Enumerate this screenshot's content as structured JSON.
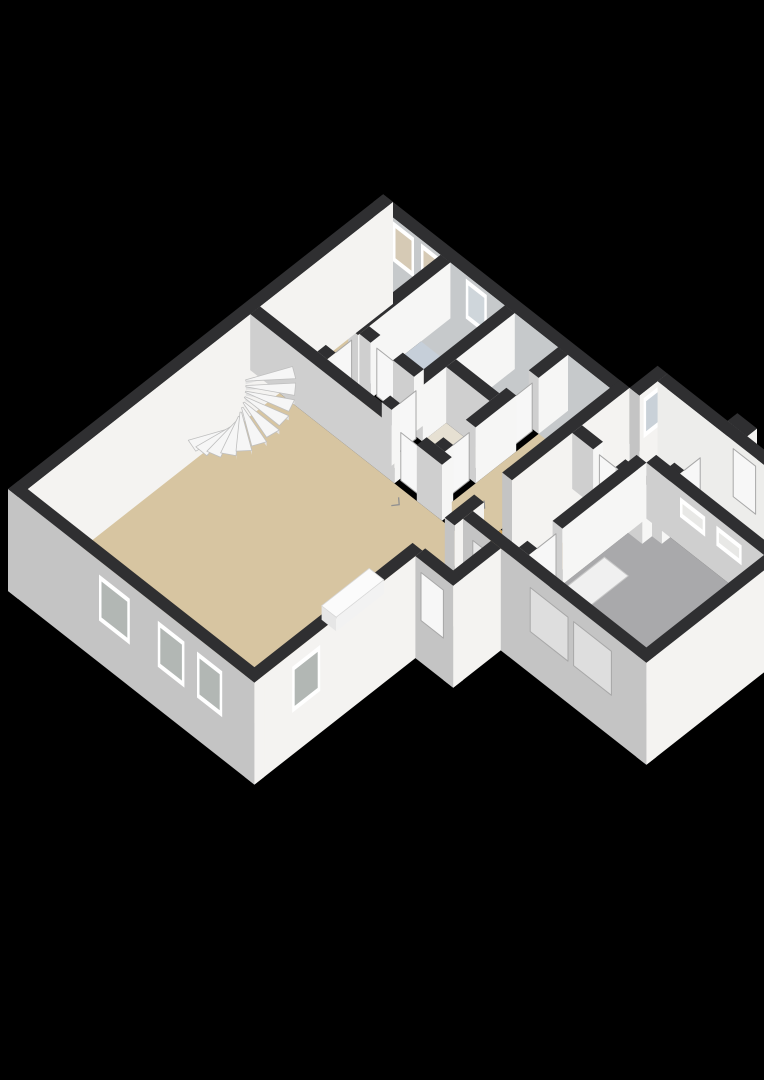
{
  "scene": {
    "kind": "isometric-3d-floorplan-render",
    "background": "#000000",
    "width": 764,
    "height": 1080
  },
  "palette": {
    "background": "#000000",
    "wallTop": "#2f2f31",
    "extSW": "#c4c4c4",
    "extSE": "#f4f3f1",
    "intSW": "#cfcfcf",
    "intSE": "#f6f6f5",
    "frame": "#ffffff",
    "leaf": "#f7f7f7",
    "leafStroke": "#a8a8a8",
    "floorTan": "#d7c5a1",
    "floorOrange": "#d2a75e",
    "floorBlue": "#c4ccd6",
    "floorGray": "#a9a9ab",
    "floorMutedTan": "#c6b795"
  },
  "plan": {
    "projection": {
      "ox": 8,
      "oy": 545,
      "k": 28,
      "m": 22,
      "wallHeight": 56,
      "plinth": 46
    },
    "floors": [
      {
        "name": "living-room-floor",
        "points": [
          [
            0.35,
            0.35
          ],
          [
            8.3,
            0.35
          ],
          [
            8.3,
            8.45
          ],
          [
            0.35,
            8.45
          ]
        ],
        "color": "#d7c5a1"
      },
      {
        "name": "bedroom-floor",
        "points": [
          [
            8.65,
            0.35
          ],
          [
            13.05,
            0.35
          ],
          [
            13.05,
            2.4
          ],
          [
            8.65,
            2.4
          ]
        ],
        "color": "#d7c5a1"
      },
      {
        "name": "inner-hall-floor",
        "points": [
          [
            8.65,
            2.75
          ],
          [
            9.8,
            2.75
          ],
          [
            9.8,
            4.7
          ],
          [
            8.65,
            4.7
          ]
        ],
        "color": "#dcd0b4"
      },
      {
        "name": "bathroom-floor",
        "points": [
          [
            10.15,
            2.75
          ],
          [
            13.05,
            2.75
          ],
          [
            13.05,
            4.7
          ],
          [
            10.15,
            4.7
          ]
        ],
        "color": "#c6cfd9"
      },
      {
        "name": "closet-a-floor",
        "points": [
          [
            8.65,
            5.05
          ],
          [
            10.6,
            5.05
          ],
          [
            10.6,
            6.6
          ],
          [
            8.65,
            6.6
          ]
        ],
        "color": "#e6e0d2"
      },
      {
        "name": "closet-b-floor",
        "points": [
          [
            10.95,
            5.05
          ],
          [
            13.05,
            5.05
          ],
          [
            13.05,
            6.6
          ],
          [
            10.95,
            6.6
          ]
        ],
        "color": "#e6e0d2"
      },
      {
        "name": "entry-hall-floor",
        "points": [
          [
            8.65,
            6.95
          ],
          [
            13.05,
            6.95
          ],
          [
            13.05,
            8.45
          ],
          [
            8.65,
            8.45
          ]
        ],
        "color": "#d8c7a4"
      },
      {
        "name": "vestibule-floor",
        "points": [
          [
            6.05,
            8.45
          ],
          [
            7.12,
            8.45
          ],
          [
            7.12,
            9.8
          ],
          [
            6.05,
            9.8
          ]
        ],
        "color": "#d5c29c"
      },
      {
        "name": "west-hall-floor",
        "points": [
          [
            7.8,
            8.8
          ],
          [
            11.35,
            8.8
          ],
          [
            11.35,
            10.45
          ],
          [
            7.8,
            10.45
          ]
        ],
        "color": "#d2a75e"
      },
      {
        "name": "hall-doorway-floor",
        "points": [
          [
            8.25,
            8.45
          ],
          [
            9.15,
            8.45
          ],
          [
            9.15,
            8.8
          ],
          [
            8.25,
            8.8
          ]
        ],
        "color": "#d2a75e"
      },
      {
        "name": "corridor-floor",
        "points": [
          [
            11.7,
            8.8
          ],
          [
            13.4,
            8.8
          ],
          [
            13.4,
            9.15
          ],
          [
            14.05,
            9.15
          ],
          [
            14.05,
            11.3
          ],
          [
            11.7,
            11.3
          ]
        ],
        "color": "#c4ccd6"
      },
      {
        "name": "garage-floor",
        "points": [
          [
            7.8,
            10.8
          ],
          [
            12.0,
            10.8
          ],
          [
            12.0,
            15.0
          ],
          [
            7.8,
            15.0
          ]
        ],
        "color": "#a9a9ab"
      },
      {
        "name": "storeroom-floor",
        "points": [
          [
            12.35,
            11.65
          ],
          [
            14.05,
            11.65
          ],
          [
            14.05,
            15.0
          ],
          [
            12.35,
            15.0
          ]
        ],
        "color": "#c6b795"
      }
    ],
    "flat_details": [
      {
        "name": "garage-floor-hatch",
        "points": [
          [
            8.35,
            10.95
          ],
          [
            10.35,
            10.95
          ],
          [
            10.35,
            11.8
          ],
          [
            8.35,
            11.8
          ]
        ],
        "color": "#f0f0f0",
        "stroke": "#c8c8c8"
      }
    ],
    "door_marks": [
      {
        "name": "door-swing-mark",
        "at": [
          7.9,
          5.95
        ]
      },
      {
        "name": "door-swing-mark",
        "at": [
          9.35,
          7.55
        ]
      },
      {
        "name": "door-swing-mark",
        "at": [
          10.85,
          9.95
        ]
      },
      {
        "name": "door-swing-mark",
        "at": [
          6.62,
          9.3
        ]
      },
      {
        "name": "door-swing-mark",
        "at": [
          12.9,
          12.1
        ]
      }
    ],
    "walls": [
      {
        "name": "main-nw-wall",
        "rect": [
          0,
          0,
          13.4,
          0.35
        ],
        "ext": true
      },
      {
        "name": "main-ne-wall",
        "rect": [
          13.05,
          0,
          13.4,
          8.8
        ],
        "ext": true,
        "sw": "#c6c9cb",
        "windows": [
          {
            "face": "SW",
            "lo": 0.7,
            "hi": 1.45,
            "z1": 12,
            "z2": 52,
            "pane": "#d6cab5"
          },
          {
            "face": "SW",
            "lo": 1.7,
            "hi": 2.45,
            "z1": 12,
            "z2": 52,
            "pane": "#d6cab5"
          },
          {
            "face": "SW",
            "lo": 3.3,
            "hi": 4.05,
            "z1": 12,
            "z2": 52,
            "pane": "#cfd6db"
          }
        ]
      },
      {
        "name": "main-sw-wall",
        "rect": [
          0,
          0,
          0.35,
          8.8
        ],
        "ext": true,
        "windows": [
          {
            "face": "SW",
            "lo": 3.25,
            "hi": 4.35,
            "z1": -4,
            "z2": 42,
            "pane": "#b2b7b4"
          },
          {
            "face": "SW",
            "lo": 5.35,
            "hi": 6.3,
            "z1": -4,
            "z2": 42,
            "pane": "#b2b7b4"
          },
          {
            "face": "SW",
            "lo": 6.75,
            "hi": 7.65,
            "z1": -4,
            "z2": 42,
            "pane": "#b2b7b4"
          }
        ]
      },
      {
        "name": "main-se-wall-west",
        "rect": [
          0,
          8.45,
          6.0,
          8.8
        ],
        "ext": true,
        "z": 2.5,
        "windows": [
          {
            "face": "SE",
            "lo": 1.35,
            "hi": 2.35,
            "z1": -4,
            "z2": 42,
            "pane": "#b2b7b4"
          }
        ]
      },
      {
        "name": "main-se-wall-mid",
        "rect": [
          7.15,
          8.45,
          8.2,
          8.8
        ],
        "ext": true
      },
      {
        "name": "main-se-wall-east",
        "rect": [
          9.2,
          8.45,
          13.4,
          8.8
        ],
        "ext": true
      },
      {
        "name": "wing-nw-wall",
        "rect": [
          13.4,
          8.8,
          14.4,
          9.15
        ],
        "ext": true,
        "windows": [
          {
            "face": "SE",
            "lo": 13.55,
            "hi": 14.15,
            "z1": 10,
            "z2": 50,
            "pane": "#c9d1d8"
          }
        ]
      },
      {
        "name": "wing-ne-wall",
        "rect": [
          14.05,
          9.15,
          14.4,
          15.35
        ],
        "ext": true,
        "sw": "#ededeb",
        "doors": [
          {
            "face": "SW",
            "lo": 11.85,
            "hi": 12.65,
            "z1": 0,
            "z2": 48
          }
        ]
      },
      {
        "name": "wing-se-wall",
        "rect": [
          7.45,
          15.0,
          14.4,
          15.35
        ],
        "ext": true,
        "windows": [
          {
            "face": "SE",
            "lo": 12.55,
            "hi": 13.05,
            "z1": 16,
            "z2": 40,
            "pane": "#b2b7b4"
          }
        ]
      },
      {
        "name": "wing-sw-wall",
        "rect": [
          7.45,
          8.8,
          7.8,
          15.35
        ],
        "ext": true,
        "z": 3.3,
        "doors": [
          {
            "face": "SW",
            "lo": 9.15,
            "hi": 9.9,
            "z1": -4,
            "z2": 42,
            "fill": "#e8e8e8"
          },
          {
            "face": "SW",
            "lo": 11.2,
            "hi": 12.55,
            "z1": -4,
            "z2": 40,
            "fill": "#dedede"
          },
          {
            "face": "SW",
            "lo": 12.75,
            "hi": 14.1,
            "z1": -4,
            "z2": 40,
            "fill": "#dedede"
          }
        ]
      },
      {
        "name": "vestibule-sw-wall",
        "rect": [
          5.75,
          8.8,
          6.1,
          10.15
        ],
        "ext": true,
        "doors": [
          {
            "face": "SW",
            "lo": 9.0,
            "hi": 9.8,
            "z1": -4,
            "z2": 44
          }
        ]
      },
      {
        "name": "vestibule-se-wall",
        "rect": [
          5.75,
          9.8,
          7.45,
          10.15
        ],
        "ext": true
      },
      {
        "name": "stair-closet-wall",
        "rect": [
          8.3,
          0.35,
          8.65,
          5.5
        ]
      },
      {
        "name": "living-hall-wall",
        "rect": [
          8.3,
          6.3,
          8.65,
          7.2
        ]
      },
      {
        "name": "bedroom-wall-w",
        "rect": [
          8.65,
          2.4,
          8.95,
          2.75
        ]
      },
      {
        "name": "bedroom-wall-e",
        "rect": [
          9.75,
          2.4,
          13.05,
          2.75
        ]
      },
      {
        "name": "bathroom-wall-n",
        "rect": [
          9.8,
          2.75,
          10.15,
          3.15
        ]
      },
      {
        "name": "bathroom-wall-s",
        "rect": [
          9.8,
          3.95,
          10.15,
          4.7
        ]
      },
      {
        "name": "hall-wall-w",
        "rect": [
          8.65,
          4.7,
          8.95,
          5.05
        ]
      },
      {
        "name": "hall-wall-e",
        "rect": [
          9.75,
          4.7,
          13.05,
          5.05
        ]
      },
      {
        "name": "closet-divider-wall",
        "rect": [
          10.6,
          5.05,
          10.95,
          6.6
        ]
      },
      {
        "name": "entry-wall-a",
        "rect": [
          8.65,
          6.6,
          8.95,
          6.95
        ]
      },
      {
        "name": "entry-wall-b",
        "rect": [
          9.75,
          6.6,
          11.2,
          6.95
        ]
      },
      {
        "name": "entry-wall-c",
        "rect": [
          12.0,
          6.6,
          13.05,
          6.95
        ]
      },
      {
        "name": "corridor-wall-n",
        "rect": [
          11.35,
          8.8,
          11.7,
          9.55
        ]
      },
      {
        "name": "corridor-wall-s",
        "rect": [
          11.35,
          10.35,
          11.7,
          11.3
        ]
      },
      {
        "name": "garage-wall-nw-a",
        "rect": [
          7.8,
          10.45,
          8.1,
          10.8
        ]
      },
      {
        "name": "garage-wall-nw-b",
        "rect": [
          9.0,
          10.45,
          12.0,
          10.8
        ]
      },
      {
        "name": "corridor-store-wall-a",
        "rect": [
          11.7,
          11.3,
          12.5,
          11.65
        ]
      },
      {
        "name": "corridor-store-wall-b",
        "rect": [
          13.3,
          11.3,
          14.05,
          11.65
        ]
      },
      {
        "name": "garage-store-wall",
        "rect": [
          12.0,
          10.8,
          12.35,
          15.0
        ],
        "windows": [
          {
            "face": "SW",
            "lo": 12.0,
            "hi": 12.9,
            "z1": 28,
            "z2": 48,
            "pane": "#e8e8e6"
          },
          {
            "face": "SW",
            "lo": 13.3,
            "hi": 14.2,
            "z1": 28,
            "z2": 48,
            "pane": "#e8e8e6"
          }
        ]
      },
      {
        "name": "exterior-step",
        "rect": [
          14.4,
          11.3,
          14.75,
          12.0
        ],
        "ext": true
      }
    ],
    "door_leaves": [
      {
        "name": "hall-door",
        "plane": "a",
        "at": 8.48,
        "lo": 5.55,
        "hi": 6.25,
        "z1": 0,
        "z2": 48
      },
      {
        "name": "bedroom-door",
        "plane": "b",
        "at": 2.57,
        "lo": 9.0,
        "hi": 9.7,
        "z1": 0,
        "z2": 48
      },
      {
        "name": "bathroom-door",
        "plane": "a",
        "at": 9.97,
        "lo": 3.2,
        "hi": 3.9,
        "z1": 0,
        "z2": 48
      },
      {
        "name": "hall-inner-door",
        "plane": "b",
        "at": 4.87,
        "lo": 9.0,
        "hi": 9.7,
        "z1": 0,
        "z2": 48
      },
      {
        "name": "closet-a-door",
        "plane": "b",
        "at": 6.77,
        "lo": 9.0,
        "hi": 9.7,
        "z1": 0,
        "z2": 48
      },
      {
        "name": "closet-b-door",
        "plane": "b",
        "at": 6.77,
        "lo": 11.25,
        "hi": 11.95,
        "z1": 0,
        "z2": 48
      },
      {
        "name": "corridor-door",
        "plane": "a",
        "at": 11.52,
        "lo": 9.6,
        "hi": 10.3,
        "z1": 0,
        "z2": 48
      },
      {
        "name": "garage-door",
        "plane": "b",
        "at": 10.62,
        "lo": 8.15,
        "hi": 8.95,
        "z1": 0,
        "z2": 48
      },
      {
        "name": "storeroom-door",
        "plane": "b",
        "at": 11.47,
        "lo": 12.55,
        "hi": 13.25,
        "z1": 0,
        "z2": 48
      }
    ],
    "stairs": {
      "name": "winder-staircase",
      "pole": [
        6.8,
        1.5
      ],
      "innerRadius": 0.14,
      "outerRadius": 1.4,
      "startDeg": 205,
      "endDeg": 25,
      "steps": 11,
      "rise": 4.4,
      "baseZ": 3,
      "tread": "#f6f6f6",
      "riser": "#e2e2e2",
      "edge": "#bfbfbf"
    },
    "furniture": [
      {
        "name": "living-room-sideboard",
        "rect": [
          3.9,
          7.3,
          5.6,
          7.82
        ],
        "h": 14,
        "top": "#fbfbfb",
        "swf": "#e6e6e6",
        "sef": "#f2f2f2"
      },
      {
        "name": "bathtub",
        "rect": [
          10.3,
          3.98,
          11.95,
          4.62
        ],
        "h": 13,
        "top": "#fafafa",
        "swf": "#e9e9e9",
        "sef": "#f3f3f3"
      }
    ]
  }
}
